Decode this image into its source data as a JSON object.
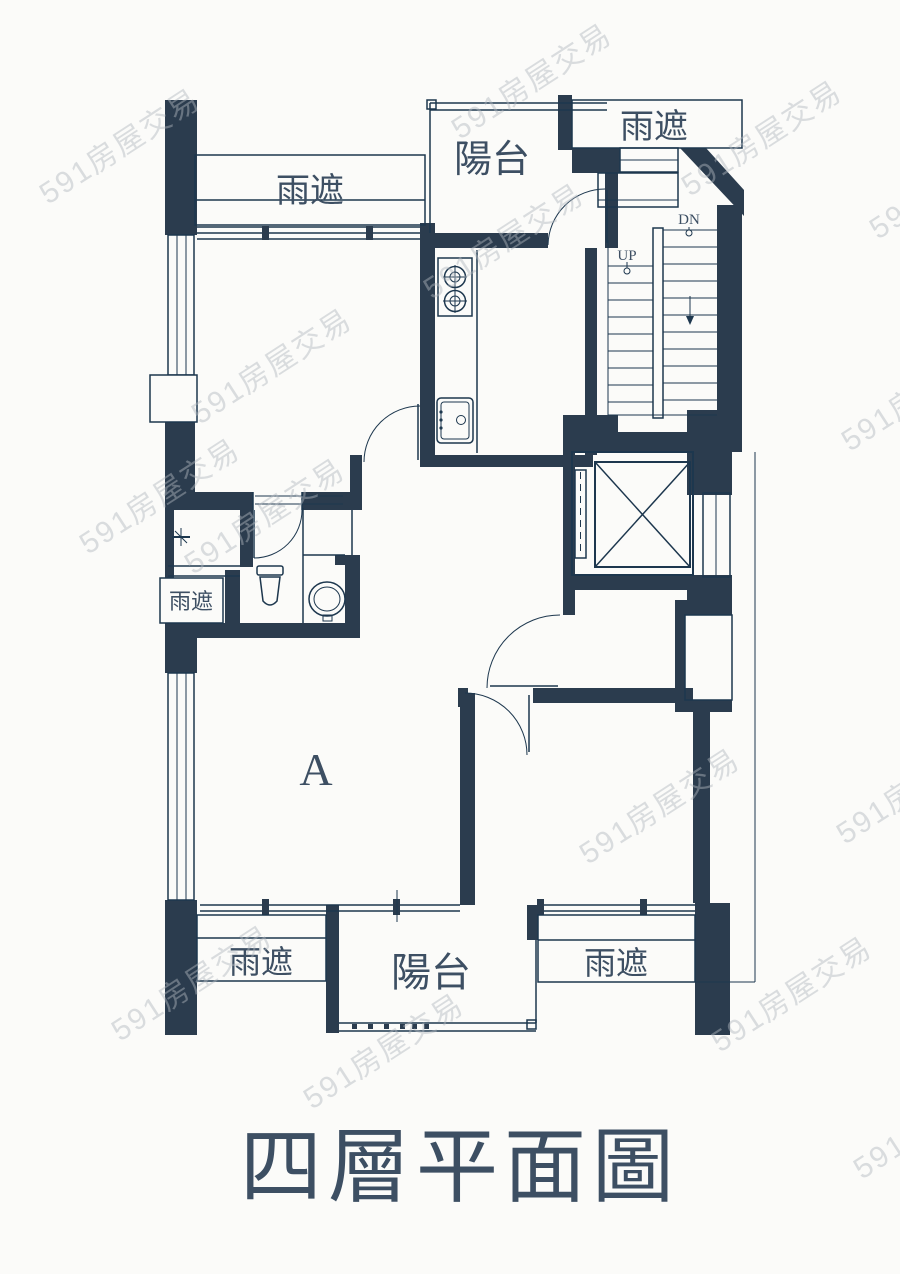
{
  "page": {
    "title": "四層平面圖"
  },
  "colors": {
    "wall": "#2b3c4e",
    "line": "#1d374e",
    "label": "#3d4f63",
    "paper": "#fbfbf9",
    "wm": "#b2b8bf"
  },
  "plan": {
    "labels": {
      "canopy_top_left": "雨遮",
      "balcony_top": "陽台",
      "canopy_top_right": "雨遮",
      "stair_down": "DN",
      "stair_up": "UP",
      "canopy_mid_left": "雨遮",
      "unit": "A",
      "canopy_bottom_left": "雨遮",
      "balcony_bottom": "陽台",
      "canopy_bottom_right": "雨遮"
    }
  },
  "fixtures": {
    "stove-icon": "two-burner gas stove",
    "kitchen-sink-icon": "rectangular kitchen sink",
    "toilet-icon": "toilet",
    "wash-basin-icon": "round wash basin",
    "elevator-icon": "elevator shaft with X",
    "stairs-icon": "stair treads with UP/DN",
    "shaft-icon": "cross-hatched duct shaft"
  },
  "watermark": {
    "text": "591房屋交易",
    "positions": [
      [
        460,
        140
      ],
      [
        690,
        197
      ],
      [
        878,
        240
      ],
      [
        48,
        205
      ],
      [
        432,
        300
      ],
      [
        200,
        425
      ],
      [
        850,
        452
      ],
      [
        88,
        555
      ],
      [
        193,
        575
      ],
      [
        588,
        865
      ],
      [
        845,
        845
      ],
      [
        720,
        1053
      ],
      [
        120,
        1042
      ],
      [
        312,
        1110
      ],
      [
        862,
        1180
      ]
    ]
  }
}
